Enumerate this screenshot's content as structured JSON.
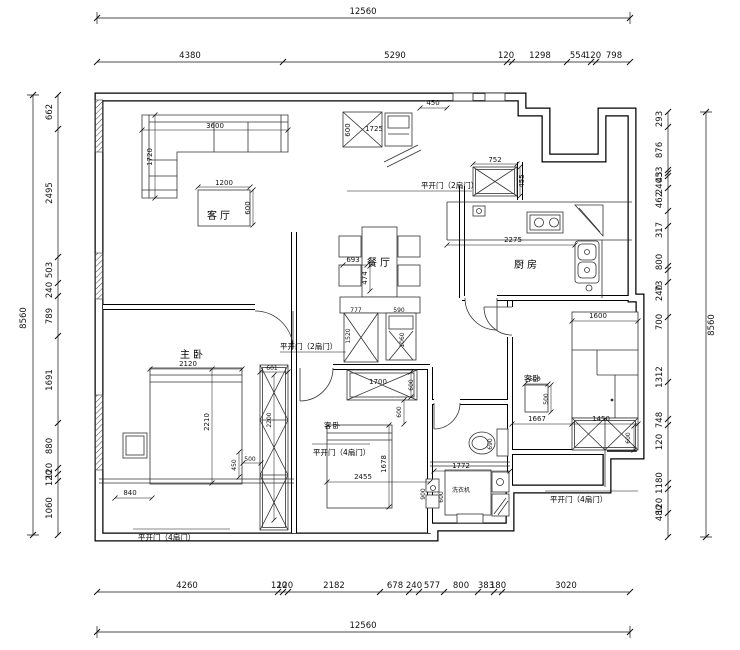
{
  "dims": {
    "top_total": "12560",
    "top": [
      "4380",
      "5290",
      "120",
      "1298",
      "554",
      "120",
      "798"
    ],
    "bottom": [
      "4260",
      "120",
      "120",
      "2182",
      "678",
      "240",
      "577",
      "800",
      "383",
      "180",
      "3020"
    ],
    "bottom_total": "12560",
    "left_total": "8560",
    "left": [
      "662",
      "2495",
      "503",
      "240",
      "789",
      "1691",
      "880",
      "120",
      "120",
      "1060"
    ],
    "right_total": "8560",
    "right": [
      "293",
      "876",
      "53",
      "43",
      "240",
      "462",
      "317",
      "800",
      "73",
      "240",
      "700",
      "1312",
      "748",
      "120",
      "1180",
      "120",
      "480"
    ]
  },
  "rooms": {
    "living": "客厅",
    "dining": "餐厅",
    "kitchen": "厨房",
    "master": "主卧",
    "guest1": "客卧",
    "guest2": "客卧",
    "laundry": "洗衣机"
  },
  "doors": {
    "two_panel": "平开门（2扇门）",
    "four_panel": "平开门（4扇门）"
  },
  "furn": {
    "sofa_w": "3600",
    "sofa_d": "1720",
    "table_w": "1200",
    "table_d": "600",
    "entry_step": "450",
    "entry_d": "600",
    "entry_w": "1725",
    "cab752": "752",
    "cab455": "455",
    "counter": "2275",
    "dining_w": "693",
    "dining_d": "474",
    "sb_w1": "777",
    "sb_h1": "1520",
    "sb_w2": "590",
    "sb_h2": "1060",
    "g1_cab_w": "1700",
    "g1_cab_d": "600",
    "g1_bed_w": "2455",
    "g1_bed_l": "1678",
    "g1_gap": "600",
    "m_bed_w": "2120",
    "m_bed_l": "2210",
    "m_ward_w": "601",
    "m_ward_l": "2200",
    "m_500": "500",
    "m_450": "450",
    "m_840": "840",
    "g2_bed_w": "1600",
    "g2_500a": "500",
    "g2_500b": "500",
    "g2_gap": "1667",
    "g2_ward_w": "1450",
    "g2_ward_d": "600",
    "bath_w": "1772",
    "toilet": "690",
    "bath_a": "900",
    "bath_b": "600"
  }
}
